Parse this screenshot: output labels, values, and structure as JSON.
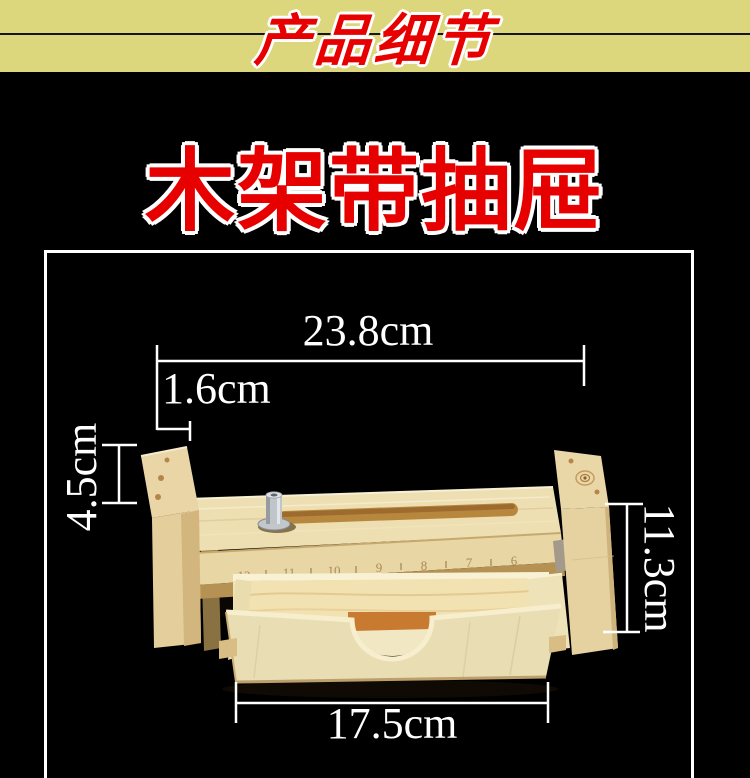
{
  "banner": {
    "label": "产品细节",
    "background": "#dcd67c",
    "text_color": "#e60000",
    "divider_color": "#161616"
  },
  "title": {
    "text": "木架带抽屉",
    "color": "#e60000",
    "outline_color": "#ffffff"
  },
  "figure": {
    "frame_color": "#ffffff",
    "background": "#000000",
    "illustration": "wood-soap-cutter-rack-with-drawer-photo",
    "dimensions": {
      "top_width": "23.8cm",
      "end_post_thickness": "1.6cm",
      "end_post_height": "4.5cm",
      "side_height": "11.3cm",
      "drawer_width": "17.5cm"
    },
    "ruler_marks": [
      "12",
      "11",
      "10",
      "9",
      "8",
      "7",
      "6"
    ]
  }
}
